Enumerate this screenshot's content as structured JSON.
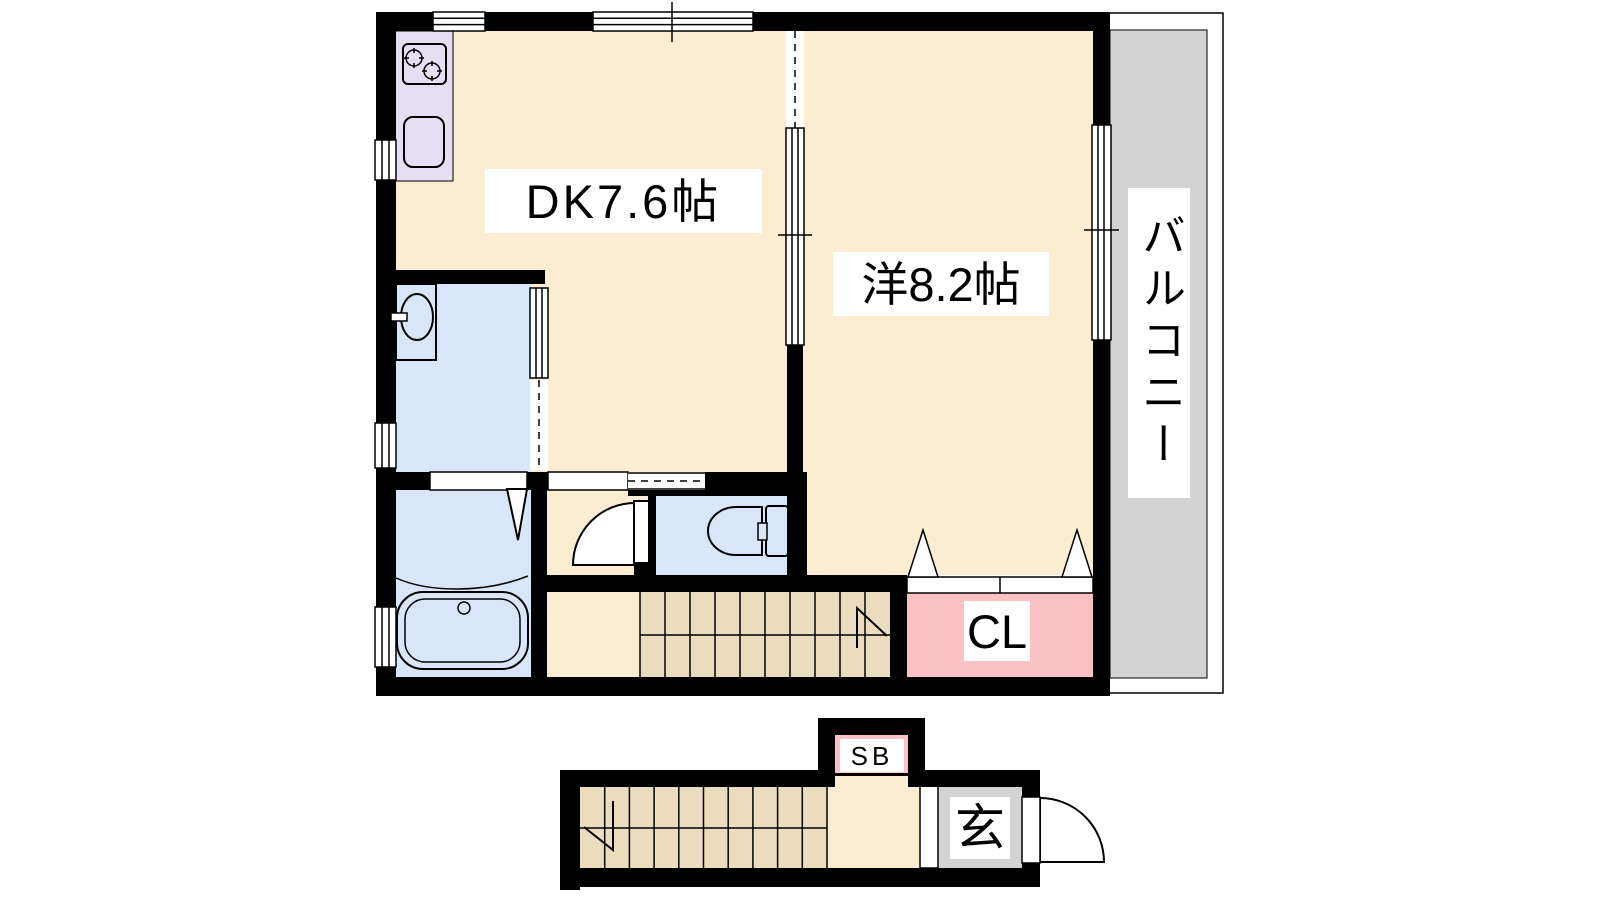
{
  "floorplan": {
    "rooms": {
      "dining_kitchen": "DK7.6帖",
      "western_room": "洋8.2帖",
      "balcony": "バルコニー",
      "closet": "CL",
      "shoe_box": "SB",
      "entrance": "玄"
    },
    "colors": {
      "floor-cream": "#FAEDD1",
      "stair-tan": "#EBDCBE",
      "water-blue": "#D9E6F8",
      "closet-pink": "#FBC2C6",
      "balcony-gray": "#D3D3D3",
      "kitchen-lavender": "#E6DEF2",
      "wall-black": "#000000",
      "label-bg": "#FFFFFF"
    }
  }
}
